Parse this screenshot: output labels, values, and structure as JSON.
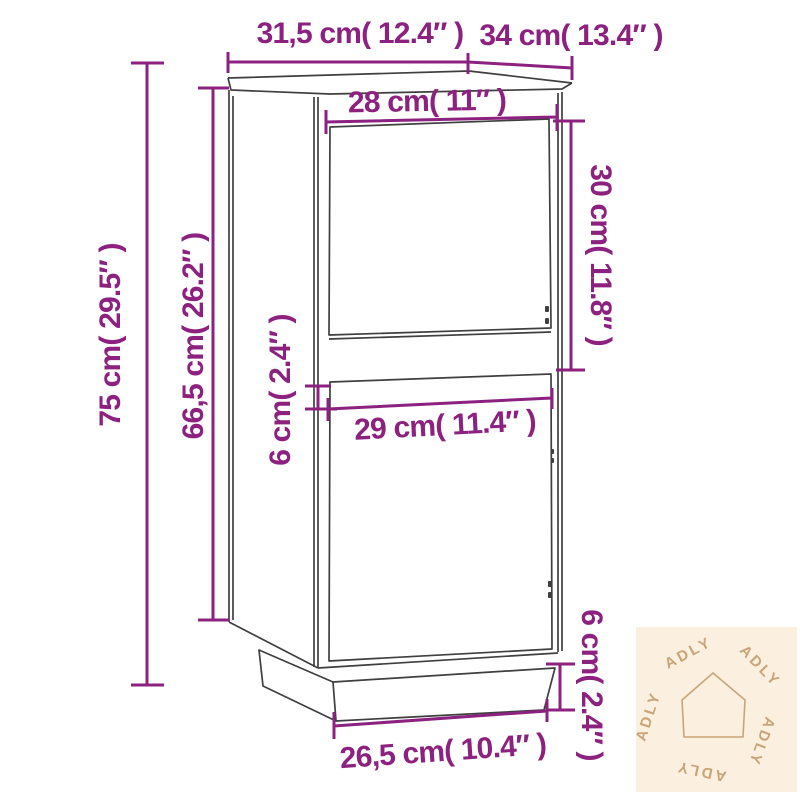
{
  "diagram": {
    "description": "Technical dimension drawing of a two-door sideboard cabinet shown in light perspective with plinth base",
    "unit_system": "centimeters with inches in parentheses"
  },
  "dimensions": {
    "top_width": {
      "label": "31,5 cm( 12.4″ )",
      "cm": "31,5",
      "inch": "12.4"
    },
    "top_depth": {
      "label": "34 cm( 13.4″ )",
      "cm": "34",
      "inch": "13.4"
    },
    "upper_door_width": {
      "label": "28 cm( 11″ )",
      "cm": "28",
      "inch": "11"
    },
    "upper_door_height": {
      "label": "30 cm( 11.8″ )",
      "cm": "30",
      "inch": "11.8"
    },
    "total_height": {
      "label": "75 cm( 29.5″ )",
      "cm": "75",
      "inch": "29.5"
    },
    "body_height": {
      "label": "66,5 cm( 26.2″ )",
      "cm": "66,5",
      "inch": "26.2"
    },
    "door_gap_height": {
      "label": "6 cm( 2.4″ )",
      "cm": "6",
      "inch": "2.4"
    },
    "lower_door_width": {
      "label": "29 cm( 11.4″ )",
      "cm": "29",
      "inch": "11.4"
    },
    "plinth_width": {
      "label": "26,5 cm( 10.4″ )",
      "cm": "26,5",
      "inch": "10.4"
    },
    "plinth_height": {
      "label": "6 cm( 2.4″ )",
      "cm": "6",
      "inch": "2.4"
    }
  },
  "watermark": {
    "brand": "ADLY",
    "icon": "house-icon"
  },
  "colors": {
    "dimension_accent": "#8c2180",
    "cabinet_outline": "#3f3f3f",
    "watermark_bg": "#fbf0e0",
    "watermark_fg": "#c9a478",
    "background": "#ffffff"
  }
}
